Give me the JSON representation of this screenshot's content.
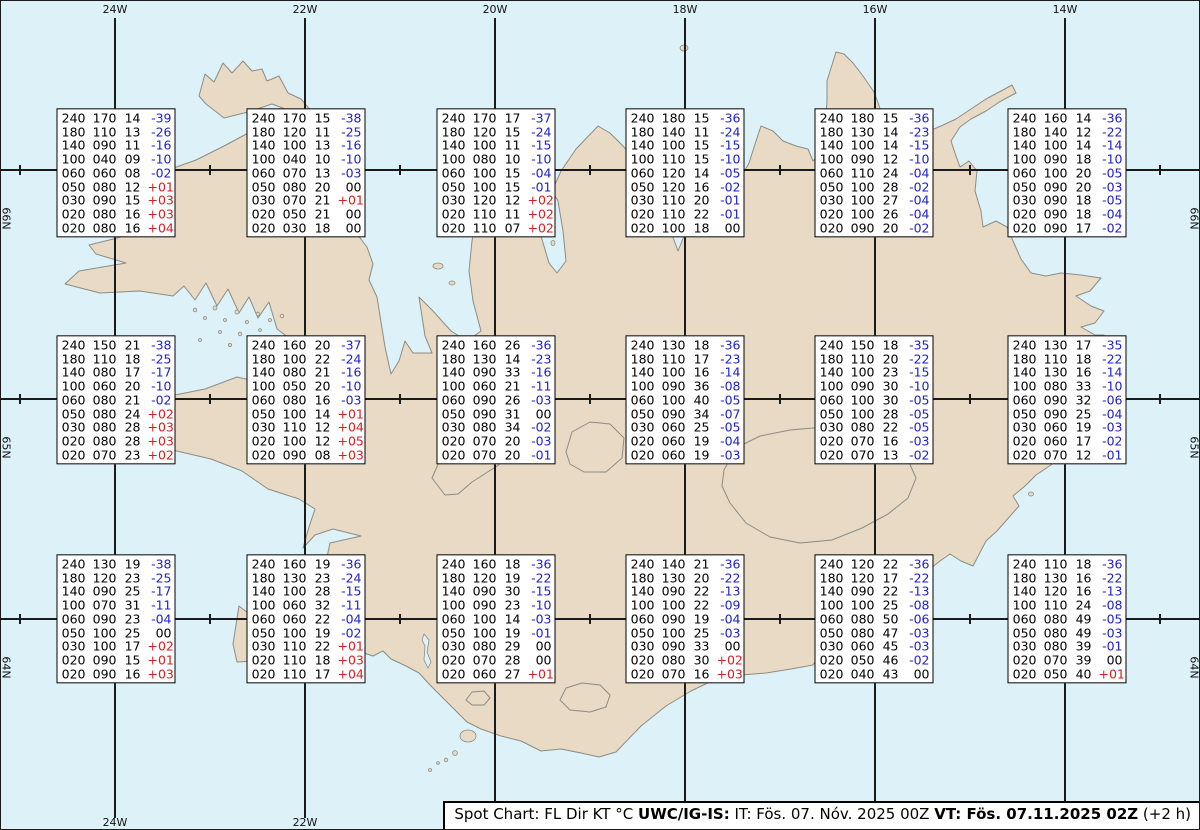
{
  "title": "Spot Chart Iceland",
  "colors": {
    "sea": "#ddf2f8",
    "land": "#e8dac4",
    "coast": "#8c8c85",
    "grid": "#1b1b1b",
    "temp_neg": "#1f1fc8",
    "temp_pos": "#d32020",
    "temp_zero": "#000000"
  },
  "grid": {
    "meridians": [
      {
        "label": "24W",
        "x": 115
      },
      {
        "label": "22W",
        "x": 305
      },
      {
        "label": "20W",
        "x": 495
      },
      {
        "label": "18W",
        "x": 685
      },
      {
        "label": "16W",
        "x": 875
      },
      {
        "label": "14W",
        "x": 1065
      }
    ],
    "parallels": [
      {
        "label": "66N",
        "y": 170
      },
      {
        "label": "65N",
        "y": 399
      },
      {
        "label": "64N",
        "y": 619
      }
    ],
    "minor_ticks_x": [
      20,
      210,
      400,
      590,
      780,
      970,
      1160
    ],
    "line_top": 18,
    "line_bottom": 818
  },
  "column_meaning": [
    "FL",
    "Dir",
    "KT",
    "°C"
  ],
  "stations": [
    {
      "lon": "24W",
      "lat": "66N",
      "cx": 116,
      "cy": 173,
      "rows": [
        [
          "240",
          "170",
          "14",
          "-39"
        ],
        [
          "180",
          "110",
          "13",
          "-26"
        ],
        [
          "140",
          "090",
          "11",
          "-16"
        ],
        [
          "100",
          "040",
          "09",
          "-10"
        ],
        [
          "060",
          "060",
          "08",
          "-02"
        ],
        [
          "050",
          "080",
          "12",
          "+01"
        ],
        [
          "030",
          "090",
          "15",
          "+03"
        ],
        [
          "020",
          "080",
          "16",
          "+03"
        ],
        [
          "020",
          "080",
          "16",
          "+04"
        ]
      ]
    },
    {
      "lon": "22W",
      "lat": "66N",
      "cx": 306,
      "cy": 173,
      "rows": [
        [
          "240",
          "170",
          "15",
          "-38"
        ],
        [
          "180",
          "120",
          "11",
          "-25"
        ],
        [
          "140",
          "100",
          "13",
          "-16"
        ],
        [
          "100",
          "040",
          "10",
          "-10"
        ],
        [
          "060",
          "070",
          "13",
          "-03"
        ],
        [
          "050",
          "080",
          "20",
          "00"
        ],
        [
          "030",
          "070",
          "21",
          "+01"
        ],
        [
          "020",
          "050",
          "21",
          "00"
        ],
        [
          "020",
          "030",
          "18",
          "00"
        ]
      ]
    },
    {
      "lon": "20W",
      "lat": "66N",
      "cx": 496,
      "cy": 173,
      "rows": [
        [
          "240",
          "170",
          "17",
          "-37"
        ],
        [
          "180",
          "120",
          "15",
          "-24"
        ],
        [
          "140",
          "100",
          "11",
          "-15"
        ],
        [
          "100",
          "080",
          "10",
          "-10"
        ],
        [
          "060",
          "100",
          "15",
          "-04"
        ],
        [
          "050",
          "100",
          "15",
          "-01"
        ],
        [
          "030",
          "120",
          "12",
          "+02"
        ],
        [
          "020",
          "110",
          "11",
          "+02"
        ],
        [
          "020",
          "110",
          "07",
          "+02"
        ]
      ]
    },
    {
      "lon": "18W",
      "lat": "66N",
      "cx": 685,
      "cy": 173,
      "rows": [
        [
          "240",
          "180",
          "15",
          "-36"
        ],
        [
          "180",
          "140",
          "11",
          "-24"
        ],
        [
          "140",
          "100",
          "15",
          "-15"
        ],
        [
          "100",
          "110",
          "15",
          "-10"
        ],
        [
          "060",
          "120",
          "14",
          "-05"
        ],
        [
          "050",
          "120",
          "16",
          "-02"
        ],
        [
          "030",
          "110",
          "20",
          "-01"
        ],
        [
          "020",
          "110",
          "22",
          "-01"
        ],
        [
          "020",
          "100",
          "18",
          "00"
        ]
      ]
    },
    {
      "lon": "16W",
      "lat": "66N",
      "cx": 874,
      "cy": 173,
      "rows": [
        [
          "240",
          "180",
          "15",
          "-36"
        ],
        [
          "180",
          "130",
          "14",
          "-23"
        ],
        [
          "140",
          "100",
          "14",
          "-15"
        ],
        [
          "100",
          "090",
          "12",
          "-10"
        ],
        [
          "060",
          "110",
          "24",
          "-04"
        ],
        [
          "050",
          "100",
          "28",
          "-02"
        ],
        [
          "030",
          "100",
          "27",
          "-04"
        ],
        [
          "020",
          "100",
          "26",
          "-04"
        ],
        [
          "020",
          "090",
          "20",
          "-02"
        ]
      ]
    },
    {
      "lon": "14W",
      "lat": "66N",
      "cx": 1067,
      "cy": 173,
      "rows": [
        [
          "240",
          "160",
          "14",
          "-36"
        ],
        [
          "180",
          "140",
          "12",
          "-22"
        ],
        [
          "140",
          "100",
          "14",
          "-14"
        ],
        [
          "100",
          "090",
          "18",
          "-10"
        ],
        [
          "060",
          "100",
          "20",
          "-05"
        ],
        [
          "050",
          "090",
          "20",
          "-03"
        ],
        [
          "030",
          "090",
          "18",
          "-05"
        ],
        [
          "020",
          "090",
          "18",
          "-04"
        ],
        [
          "020",
          "090",
          "17",
          "-02"
        ]
      ]
    },
    {
      "lon": "24W",
      "lat": "65N",
      "cx": 116,
      "cy": 400,
      "rows": [
        [
          "240",
          "150",
          "21",
          "-38"
        ],
        [
          "180",
          "110",
          "18",
          "-25"
        ],
        [
          "140",
          "080",
          "17",
          "-17"
        ],
        [
          "100",
          "060",
          "20",
          "-10"
        ],
        [
          "060",
          "080",
          "21",
          "-02"
        ],
        [
          "050",
          "080",
          "24",
          "+02"
        ],
        [
          "030",
          "080",
          "28",
          "+03"
        ],
        [
          "020",
          "080",
          "28",
          "+03"
        ],
        [
          "020",
          "070",
          "23",
          "+02"
        ]
      ]
    },
    {
      "lon": "22W",
      "lat": "65N",
      "cx": 306,
      "cy": 400,
      "rows": [
        [
          "240",
          "160",
          "20",
          "-37"
        ],
        [
          "180",
          "100",
          "22",
          "-24"
        ],
        [
          "140",
          "080",
          "21",
          "-16"
        ],
        [
          "100",
          "050",
          "20",
          "-10"
        ],
        [
          "060",
          "080",
          "16",
          "-03"
        ],
        [
          "050",
          "100",
          "14",
          "+01"
        ],
        [
          "030",
          "110",
          "12",
          "+04"
        ],
        [
          "020",
          "100",
          "12",
          "+05"
        ],
        [
          "020",
          "090",
          "08",
          "+03"
        ]
      ]
    },
    {
      "lon": "20W",
      "lat": "65N",
      "cx": 496,
      "cy": 400,
      "rows": [
        [
          "240",
          "160",
          "26",
          "-36"
        ],
        [
          "180",
          "130",
          "14",
          "-23"
        ],
        [
          "140",
          "090",
          "33",
          "-16"
        ],
        [
          "100",
          "060",
          "21",
          "-11"
        ],
        [
          "060",
          "090",
          "26",
          "-03"
        ],
        [
          "050",
          "090",
          "31",
          "00"
        ],
        [
          "030",
          "080",
          "34",
          "-02"
        ],
        [
          "020",
          "070",
          "20",
          "-03"
        ],
        [
          "020",
          "070",
          "20",
          "-01"
        ]
      ]
    },
    {
      "lon": "18W",
      "lat": "65N",
      "cx": 685,
      "cy": 400,
      "rows": [
        [
          "240",
          "130",
          "18",
          "-36"
        ],
        [
          "180",
          "110",
          "17",
          "-23"
        ],
        [
          "140",
          "100",
          "16",
          "-14"
        ],
        [
          "100",
          "090",
          "36",
          "-08"
        ],
        [
          "060",
          "100",
          "40",
          "-05"
        ],
        [
          "050",
          "090",
          "34",
          "-07"
        ],
        [
          "030",
          "060",
          "25",
          "-05"
        ],
        [
          "020",
          "060",
          "19",
          "-04"
        ],
        [
          "020",
          "060",
          "19",
          "-03"
        ]
      ]
    },
    {
      "lon": "16W",
      "lat": "65N",
      "cx": 874,
      "cy": 400,
      "rows": [
        [
          "240",
          "150",
          "18",
          "-35"
        ],
        [
          "180",
          "110",
          "20",
          "-22"
        ],
        [
          "140",
          "100",
          "23",
          "-15"
        ],
        [
          "100",
          "090",
          "30",
          "-10"
        ],
        [
          "060",
          "100",
          "30",
          "-05"
        ],
        [
          "050",
          "100",
          "28",
          "-05"
        ],
        [
          "030",
          "080",
          "22",
          "-05"
        ],
        [
          "020",
          "070",
          "16",
          "-03"
        ],
        [
          "020",
          "070",
          "13",
          "-02"
        ]
      ]
    },
    {
      "lon": "14W",
      "lat": "65N",
      "cx": 1067,
      "cy": 400,
      "rows": [
        [
          "240",
          "130",
          "17",
          "-35"
        ],
        [
          "180",
          "110",
          "18",
          "-22"
        ],
        [
          "140",
          "130",
          "16",
          "-14"
        ],
        [
          "100",
          "080",
          "33",
          "-10"
        ],
        [
          "060",
          "090",
          "32",
          "-06"
        ],
        [
          "050",
          "090",
          "25",
          "-04"
        ],
        [
          "030",
          "060",
          "19",
          "-03"
        ],
        [
          "020",
          "060",
          "17",
          "-02"
        ],
        [
          "020",
          "070",
          "12",
          "-01"
        ]
      ]
    },
    {
      "lon": "24W",
      "lat": "64N",
      "cx": 116,
      "cy": 619,
      "rows": [
        [
          "240",
          "130",
          "19",
          "-38"
        ],
        [
          "180",
          "120",
          "23",
          "-25"
        ],
        [
          "140",
          "090",
          "25",
          "-17"
        ],
        [
          "100",
          "070",
          "31",
          "-11"
        ],
        [
          "060",
          "090",
          "23",
          "-04"
        ],
        [
          "050",
          "100",
          "25",
          "00"
        ],
        [
          "030",
          "100",
          "17",
          "+02"
        ],
        [
          "020",
          "090",
          "15",
          "+01"
        ],
        [
          "020",
          "090",
          "16",
          "+03"
        ]
      ]
    },
    {
      "lon": "22W",
      "lat": "64N",
      "cx": 306,
      "cy": 619,
      "rows": [
        [
          "240",
          "160",
          "19",
          "-36"
        ],
        [
          "180",
          "130",
          "23",
          "-24"
        ],
        [
          "140",
          "100",
          "28",
          "-15"
        ],
        [
          "100",
          "060",
          "32",
          "-11"
        ],
        [
          "060",
          "060",
          "22",
          "-04"
        ],
        [
          "050",
          "100",
          "19",
          "-02"
        ],
        [
          "030",
          "110",
          "22",
          "+01"
        ],
        [
          "020",
          "110",
          "18",
          "+03"
        ],
        [
          "020",
          "110",
          "17",
          "+04"
        ]
      ]
    },
    {
      "lon": "20W",
      "lat": "64N",
      "cx": 496,
      "cy": 619,
      "rows": [
        [
          "240",
          "160",
          "18",
          "-36"
        ],
        [
          "180",
          "120",
          "19",
          "-22"
        ],
        [
          "140",
          "090",
          "30",
          "-15"
        ],
        [
          "100",
          "090",
          "23",
          "-10"
        ],
        [
          "060",
          "100",
          "14",
          "-03"
        ],
        [
          "050",
          "100",
          "19",
          "-01"
        ],
        [
          "030",
          "080",
          "29",
          "00"
        ],
        [
          "020",
          "070",
          "28",
          "00"
        ],
        [
          "020",
          "060",
          "27",
          "+01"
        ]
      ]
    },
    {
      "lon": "18W",
      "lat": "64N",
      "cx": 685,
      "cy": 619,
      "rows": [
        [
          "240",
          "140",
          "21",
          "-36"
        ],
        [
          "180",
          "130",
          "20",
          "-22"
        ],
        [
          "140",
          "090",
          "22",
          "-13"
        ],
        [
          "100",
          "100",
          "22",
          "-09"
        ],
        [
          "060",
          "090",
          "19",
          "-04"
        ],
        [
          "050",
          "100",
          "25",
          "-03"
        ],
        [
          "030",
          "090",
          "33",
          "00"
        ],
        [
          "020",
          "080",
          "30",
          "+02"
        ],
        [
          "020",
          "070",
          "16",
          "+03"
        ]
      ]
    },
    {
      "lon": "16W",
      "lat": "64N",
      "cx": 874,
      "cy": 619,
      "rows": [
        [
          "240",
          "120",
          "22",
          "-36"
        ],
        [
          "180",
          "120",
          "17",
          "-22"
        ],
        [
          "140",
          "090",
          "22",
          "-13"
        ],
        [
          "100",
          "100",
          "25",
          "-08"
        ],
        [
          "060",
          "080",
          "50",
          "-06"
        ],
        [
          "050",
          "080",
          "47",
          "-03"
        ],
        [
          "030",
          "060",
          "45",
          "-03"
        ],
        [
          "020",
          "050",
          "46",
          "-02"
        ],
        [
          "020",
          "040",
          "43",
          "00"
        ]
      ]
    },
    {
      "lon": "14W",
      "lat": "64N",
      "cx": 1067,
      "cy": 619,
      "rows": [
        [
          "240",
          "110",
          "18",
          "-36"
        ],
        [
          "180",
          "130",
          "16",
          "-22"
        ],
        [
          "140",
          "120",
          "16",
          "-13"
        ],
        [
          "100",
          "110",
          "24",
          "-08"
        ],
        [
          "060",
          "080",
          "49",
          "-05"
        ],
        [
          "050",
          "080",
          "49",
          "-03"
        ],
        [
          "030",
          "080",
          "39",
          "-01"
        ],
        [
          "020",
          "070",
          "39",
          "00"
        ],
        [
          "020",
          "050",
          "40",
          "+01"
        ]
      ]
    }
  ],
  "footer": {
    "segments": [
      {
        "text": "Spot Chart: FL Dir KT °C ",
        "bold": false
      },
      {
        "text": "UWC/IG-IS:",
        "bold": true
      },
      {
        "text": " IT: Fös. 07. Nóv. 2025 00Z ",
        "bold": false
      },
      {
        "text": "VT: Fös. 07.11.2025 02Z",
        "bold": true
      },
      {
        "text": " (+2 h)",
        "bold": false
      }
    ]
  }
}
